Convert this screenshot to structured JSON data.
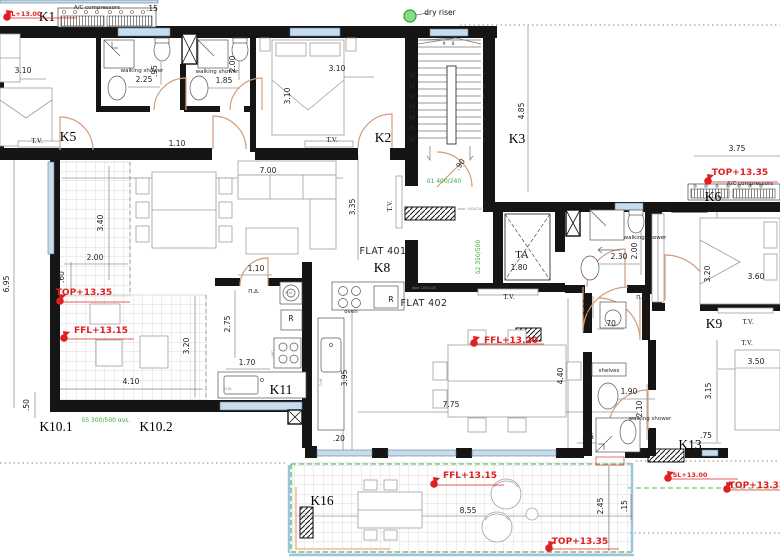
{
  "drawing": {
    "type": "architectural-floor-plan",
    "flats": [
      "FLAT 401",
      "FLAT 402"
    ],
    "rooms": [
      "K1",
      "K2",
      "K3",
      "K5",
      "K6",
      "K8",
      "K9",
      "K10.1",
      "K10.2",
      "K11",
      "K13",
      "K16"
    ],
    "levels": [
      "SL+13.00",
      "TOP+13.35",
      "FFL+13.15",
      "FFL+13.20",
      "SL+13.00",
      "TOP+13.35",
      "FFL+13.15",
      "TOP+13.35"
    ],
    "colors": {
      "wall": "#151515",
      "window": "#c7ddee",
      "door": "#d49c78",
      "level_red": "#e02020",
      "annotation_green": "#3aa83a",
      "tile_line": "#d4d4d4"
    }
  },
  "labels": [
    {
      "n": "room-label-k1",
      "t": "K1",
      "x": 47,
      "y": 21,
      "c": "room"
    },
    {
      "n": "room-label-k5",
      "t": "K5",
      "x": 68,
      "y": 141,
      "c": "room"
    },
    {
      "n": "room-label-k2",
      "t": "K2",
      "x": 383,
      "y": 142,
      "c": "room"
    },
    {
      "n": "room-label-k3",
      "t": "K3",
      "x": 517,
      "y": 143,
      "c": "room"
    },
    {
      "n": "room-label-k6",
      "t": "K6",
      "x": 713,
      "y": 201,
      "c": "room"
    },
    {
      "n": "room-label-k8",
      "t": "K8",
      "x": 382,
      "y": 272,
      "c": "room"
    },
    {
      "n": "room-label-k9",
      "t": "K9",
      "x": 714,
      "y": 328,
      "c": "room"
    },
    {
      "n": "room-label-k10-1",
      "t": "K10.1",
      "x": 56,
      "y": 431,
      "c": "room"
    },
    {
      "n": "room-label-k10-2",
      "t": "K10.2",
      "x": 156,
      "y": 431,
      "c": "room"
    },
    {
      "n": "room-label-k11",
      "t": "K11",
      "x": 281,
      "y": 394,
      "c": "room"
    },
    {
      "n": "room-label-k13",
      "t": "K13",
      "x": 690,
      "y": 449,
      "c": "room"
    },
    {
      "n": "room-label-k16",
      "t": "K16",
      "x": 322,
      "y": 505,
      "c": "room"
    },
    {
      "n": "flat-401-label",
      "t": "FLAT 401",
      "x": 383,
      "y": 254,
      "c": "flat"
    },
    {
      "n": "flat-402-label",
      "t": "FLAT 402",
      "x": 424,
      "y": 306,
      "c": "flat"
    },
    {
      "n": "level-sl-top-left",
      "t": "SL+13.00",
      "x": 24,
      "y": 16,
      "c": "redS"
    },
    {
      "n": "level-top-west",
      "t": "TOP+13.35",
      "x": 84,
      "y": 295,
      "c": "red"
    },
    {
      "n": "level-ffl-west",
      "t": "FFL+13.15",
      "x": 101,
      "y": 333,
      "c": "red"
    },
    {
      "n": "level-ffl-flat402",
      "t": "FFL+13.20",
      "x": 511,
      "y": 343,
      "c": "red"
    },
    {
      "n": "level-top-northeast",
      "t": "TOP+13.35",
      "x": 740,
      "y": 175,
      "c": "red"
    },
    {
      "n": "level-sl-southeast",
      "t": "SL+13.00",
      "x": 690,
      "y": 477,
      "c": "redS"
    },
    {
      "n": "level-top-east-edge",
      "t": "TOP+13.35",
      "x": 757,
      "y": 488,
      "c": "red"
    },
    {
      "n": "level-top-south",
      "t": "TOP+13.35",
      "x": 580,
      "y": 544,
      "c": "red"
    },
    {
      "n": "level-ffl-terrace",
      "t": "FFL+13.15",
      "x": 470,
      "y": 478,
      "c": "red"
    },
    {
      "n": "dim",
      "t": "3.10",
      "x": 23,
      "y": 73,
      "c": "dim"
    },
    {
      "n": "dim",
      "t": "2.25",
      "x": 144,
      "y": 82,
      "c": "dim"
    },
    {
      "n": "dim",
      "t": "1.85",
      "x": 224,
      "y": 83,
      "c": "dim"
    },
    {
      "n": "dim",
      "t": ".95",
      "x": 157,
      "y": 71,
      "r": -90,
      "c": "dim"
    },
    {
      "n": "dim",
      "t": "2.00",
      "x": 235,
      "y": 64,
      "r": -90,
      "c": "dim"
    },
    {
      "n": "dim",
      "t": "3.10",
      "x": 337,
      "y": 71,
      "c": "dim"
    },
    {
      "n": "dim",
      "t": "3.10",
      "x": 290,
      "y": 96,
      "r": -90,
      "c": "dim"
    },
    {
      "n": "dim",
      "t": "1.10",
      "x": 177,
      "y": 146,
      "c": "dim"
    },
    {
      "n": "dim",
      "t": ".15",
      "x": 152,
      "y": 11,
      "c": "dim"
    },
    {
      "n": "dim",
      "t": "7.00",
      "x": 268,
      "y": 173,
      "c": "dim"
    },
    {
      "n": "dim",
      "t": "3.35",
      "x": 355,
      "y": 207,
      "r": -90,
      "c": "dim"
    },
    {
      "n": "dim",
      "t": "1.10",
      "x": 256,
      "y": 271,
      "c": "dim"
    },
    {
      "n": "dim",
      "t": "4.85",
      "x": 524,
      "y": 111,
      "r": -90,
      "c": "dim"
    },
    {
      "n": "dim",
      "t": "3.75",
      "x": 737,
      "y": 151,
      "c": "dim"
    },
    {
      "n": "dim",
      "t": "3.40",
      "x": 103,
      "y": 223,
      "r": -90,
      "c": "dim"
    },
    {
      "n": "dim",
      "t": "2.00",
      "x": 95,
      "y": 260,
      "c": "dim"
    },
    {
      "n": "dim",
      "t": ".60",
      "x": 64,
      "y": 277,
      "r": -90,
      "c": "dim"
    },
    {
      "n": "dim",
      "t": "6.95",
      "x": 9,
      "y": 284,
      "r": -90,
      "c": "dim"
    },
    {
      "n": "dim",
      "t": "2.75",
      "x": 230,
      "y": 324,
      "r": -90,
      "c": "dim"
    },
    {
      "n": "dim",
      "t": "3.20",
      "x": 189,
      "y": 346,
      "r": -90,
      "c": "dim"
    },
    {
      "n": "dim",
      "t": "4.10",
      "x": 131,
      "y": 384,
      "c": "dim"
    },
    {
      "n": "dim",
      "t": ".50",
      "x": 29,
      "y": 405,
      "r": -90,
      "c": "dim"
    },
    {
      "n": "dim",
      "t": "1.70",
      "x": 247,
      "y": 365,
      "c": "dim"
    },
    {
      "n": "dim",
      "t": "1.85",
      "x": 502,
      "y": 250,
      "r": -90,
      "c": "dim"
    },
    {
      "n": "dim",
      "t": "1.80",
      "x": 519,
      "y": 270,
      "c": "dim"
    },
    {
      "n": "dim",
      "t": "2.30",
      "x": 619,
      "y": 259,
      "c": "dim"
    },
    {
      "n": "dim",
      "t": "2.00",
      "x": 637,
      "y": 251,
      "r": -90,
      "c": "dim"
    },
    {
      "n": "dim",
      "t": ".90",
      "x": 462,
      "y": 166,
      "r": -55,
      "c": "dim"
    },
    {
      "n": "dim",
      "t": "3.20",
      "x": 710,
      "y": 274,
      "r": -90,
      "c": "dim"
    },
    {
      "n": "dim",
      "t": "3.60",
      "x": 756,
      "y": 279,
      "c": "dim"
    },
    {
      "n": "dim",
      "t": "1.10",
      "x": 589,
      "y": 307,
      "r": -90,
      "c": "dim"
    },
    {
      "n": "dim",
      "t": ".70",
      "x": 610,
      "y": 326,
      "c": "dim"
    },
    {
      "n": "dim",
      "t": "4.40",
      "x": 563,
      "y": 376,
      "r": -90,
      "c": "dim"
    },
    {
      "n": "dim",
      "t": "1.90",
      "x": 629,
      "y": 394,
      "c": "dim"
    },
    {
      "n": "dim",
      "t": "2.10",
      "x": 642,
      "y": 409,
      "r": -90,
      "c": "dim"
    },
    {
      "n": "dim",
      "t": "3.15",
      "x": 711,
      "y": 391,
      "r": -90,
      "c": "dim"
    },
    {
      "n": "dim",
      "t": "3.50",
      "x": 756,
      "y": 364,
      "c": "dim"
    },
    {
      "n": "dim",
      "t": ".35",
      "x": 588,
      "y": 439,
      "c": "dim"
    },
    {
      "n": "dim",
      "t": ".75",
      "x": 706,
      "y": 438,
      "c": "dim"
    },
    {
      "n": "dim",
      "t": "3.95",
      "x": 347,
      "y": 378,
      "r": -90,
      "c": "dim"
    },
    {
      "n": "dim",
      "t": "7.75",
      "x": 451,
      "y": 407,
      "c": "dim"
    },
    {
      "n": "dim",
      "t": ".20",
      "x": 339,
      "y": 441,
      "c": "dim"
    },
    {
      "n": "dim",
      "t": "8.55",
      "x": 468,
      "y": 513,
      "c": "dim"
    },
    {
      "n": "dim",
      "t": "2.45",
      "x": 603,
      "y": 506,
      "r": -90,
      "c": "dim"
    },
    {
      "n": "dim",
      "t": ".15",
      "x": 627,
      "y": 506,
      "r": -90,
      "c": "dim"
    },
    {
      "n": "walking-shower-label",
      "t": "walking shower",
      "x": 142,
      "y": 72,
      "c": "ann"
    },
    {
      "n": "walking-shower-label",
      "t": "walking shower",
      "x": 217,
      "y": 73,
      "c": "ann"
    },
    {
      "n": "walking-shower-label",
      "t": "walking shower",
      "x": 645,
      "y": 239,
      "c": "ann"
    },
    {
      "n": "walking-shower-label",
      "t": "walking shower",
      "x": 650,
      "y": 420,
      "c": "ann"
    },
    {
      "n": "tv-label",
      "t": "T.V.",
      "x": 37,
      "y": 143,
      "c": "tv"
    },
    {
      "n": "tv-label",
      "t": "T.V.",
      "x": 332,
      "y": 142,
      "c": "tv"
    },
    {
      "n": "tv-label",
      "t": "T.V.",
      "x": 392,
      "y": 206,
      "r": -90,
      "c": "tv"
    },
    {
      "n": "tv-label",
      "t": "T.V.",
      "x": 509,
      "y": 299,
      "c": "tv"
    },
    {
      "n": "tv-label",
      "t": "T.V.",
      "x": 748,
      "y": 324,
      "c": "tv"
    },
    {
      "n": "tv-label",
      "t": "T.V.",
      "x": 747,
      "y": 345,
      "c": "tv"
    },
    {
      "n": "entry-label",
      "t": "Π.Δ.",
      "x": 254,
      "y": 293,
      "c": "ann"
    },
    {
      "n": "entry-label",
      "t": "Π.Δ.",
      "x": 642,
      "y": 299,
      "c": "ann"
    },
    {
      "n": "dry-riser-label",
      "t": "dry riser",
      "x": 440,
      "y": 15,
      "c": "ann8"
    },
    {
      "n": "ac-compressors-label",
      "t": "A/C compressors",
      "x": 97,
      "y": 9,
      "c": "ann"
    },
    {
      "n": "ac-compressors-label",
      "t": "A/C compressors",
      "x": 750,
      "y": 185,
      "c": "ann"
    },
    {
      "n": "oven-label",
      "t": "oven",
      "x": 351,
      "y": 313,
      "c": "ann"
    },
    {
      "n": "fridge-label",
      "t": "R",
      "x": 291,
      "y": 321,
      "c": "ann8"
    },
    {
      "n": "fridge-label",
      "t": "R",
      "x": 391,
      "y": 302,
      "c": "ann8"
    },
    {
      "n": "washing-machine-label",
      "t": "W.M.",
      "x": 289,
      "y": 294,
      "c": "tiny"
    },
    {
      "n": "dishwasher-label",
      "t": "D.W.",
      "x": 228,
      "y": 390,
      "c": "tiny"
    },
    {
      "n": "dishwasher-label",
      "t": "D.W.",
      "x": 322,
      "y": 382,
      "r": -90,
      "c": "tiny"
    },
    {
      "n": "oven-under-bench-label",
      "t": "UBO",
      "x": 274,
      "y": 354,
      "r": -90,
      "c": "tiny"
    },
    {
      "n": "shelves-label",
      "t": "shelves",
      "x": 609,
      "y": 372,
      "c": "ann"
    },
    {
      "n": "beam-note",
      "t": "δ1 400/240",
      "x": 444,
      "y": 183,
      "c": "grn"
    },
    {
      "n": "beam-note",
      "t": "δ2 350/500",
      "x": 480,
      "y": 257,
      "r": -90,
      "c": "grn"
    },
    {
      "n": "beam-note",
      "t": "δ5 300/500 ανε.",
      "x": 106,
      "y": 422,
      "c": "grn"
    },
    {
      "n": "elevator-label",
      "t": "ΤΑ",
      "x": 522,
      "y": 258,
      "c": "ta"
    },
    {
      "n": "door-size-note",
      "t": "door 100x220",
      "x": 470,
      "y": 210,
      "c": "tiny"
    },
    {
      "n": "door-size-note",
      "t": "door 100x220",
      "x": 424,
      "y": 289,
      "c": "tiny"
    },
    {
      "n": "stair-step-number",
      "t": "9",
      "x": 444,
      "y": 45,
      "c": "st"
    },
    {
      "n": "stair-step-number",
      "t": "8",
      "x": 453,
      "y": 45,
      "c": "st"
    },
    {
      "n": "stair-step-number",
      "t": "10",
      "x": 412,
      "y": 77,
      "c": "st"
    },
    {
      "n": "stair-step-number",
      "t": "11",
      "x": 412,
      "y": 88,
      "c": "st"
    },
    {
      "n": "stair-step-number",
      "t": "12",
      "x": 412,
      "y": 98,
      "c": "st"
    },
    {
      "n": "stair-step-number",
      "t": "13",
      "x": 412,
      "y": 108,
      "c": "st"
    },
    {
      "n": "stair-step-number",
      "t": "14",
      "x": 412,
      "y": 119,
      "c": "st"
    },
    {
      "n": "stair-step-number",
      "t": "15",
      "x": 412,
      "y": 130,
      "c": "st"
    },
    {
      "n": "stair-step-number",
      "t": "16",
      "x": 412,
      "y": 141,
      "c": "st"
    },
    {
      "n": "stair-step-number",
      "t": "7",
      "x": 484,
      "y": 77,
      "c": "st"
    },
    {
      "n": "stair-step-number",
      "t": "6",
      "x": 484,
      "y": 88,
      "c": "st"
    },
    {
      "n": "stair-step-number",
      "t": "5",
      "x": 484,
      "y": 98,
      "c": "st"
    },
    {
      "n": "stair-step-number",
      "t": "4",
      "x": 484,
      "y": 109,
      "c": "st"
    },
    {
      "n": "stair-step-number",
      "t": "3",
      "x": 484,
      "y": 120,
      "c": "st"
    },
    {
      "n": "stair-step-number",
      "t": "2",
      "x": 484,
      "y": 131,
      "c": "st"
    },
    {
      "n": "stair-step-number",
      "t": "1",
      "x": 484,
      "y": 142,
      "c": "st"
    }
  ],
  "level_markers": [
    [
      7,
      17
    ],
    [
      60,
      301
    ],
    [
      64,
      338
    ],
    [
      474,
      343
    ],
    [
      708,
      181
    ],
    [
      668,
      478
    ],
    [
      727,
      489
    ],
    [
      549,
      548
    ],
    [
      434,
      484
    ]
  ],
  "dry_riser_marker": {
    "x": 410,
    "y": 16
  }
}
